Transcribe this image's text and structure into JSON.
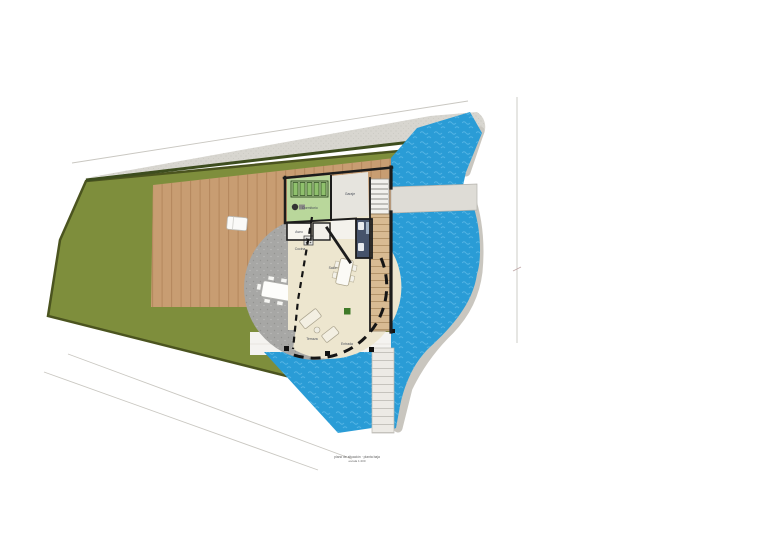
{
  "plan": {
    "title": "site-plan-floor-plan",
    "labels": {
      "bedroom": "Dormitorio",
      "garage": "Garaje",
      "wc": "Aseo",
      "kitchen": "Cocina",
      "living": "Salón",
      "terrace": "Terraza",
      "entry": "Entrada"
    },
    "caption": {
      "line1": "plano de situación · planta baja",
      "line2": "escala 1:200"
    },
    "colors": {
      "garden": "#7e8e3c",
      "garden_border": "#4b541f",
      "hedge": "#3d4d1e",
      "deck": "#c89d72",
      "road": "#d8d6d0",
      "stone": "#c9c6bf",
      "patio": "#a7a7a5",
      "interior": "#ede6cf",
      "pool": "#2a9cd6",
      "pool_wave": "#62bce8",
      "wall": "#1c1c1c",
      "bedroom_fill": "#b9d79b",
      "bed_slats": "#8fc06c",
      "garage_fill": "#e6e4de",
      "bathroom_fill": "#46536b",
      "bridge": "#dedcd6",
      "boardwalk": "#d8bb93",
      "walkway": "#f4f3f0",
      "plant": "#3f7a28",
      "boundary_line": "#c9c7c1"
    }
  }
}
